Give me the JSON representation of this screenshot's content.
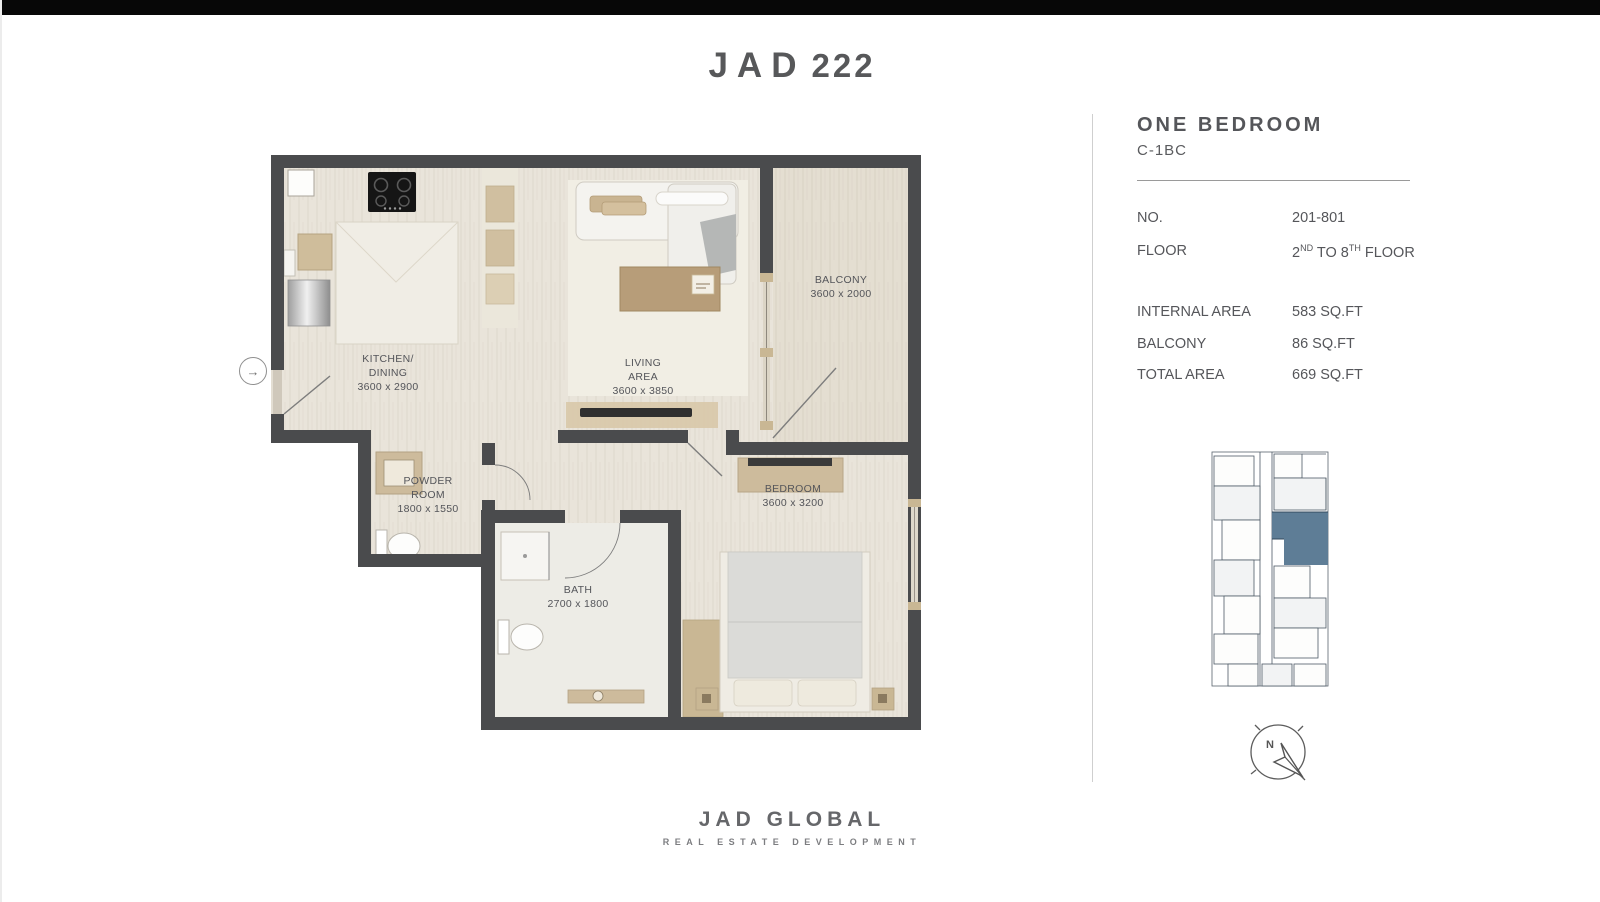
{
  "colors": {
    "top_bar": "#070707",
    "wall": "#4a4b4d",
    "floor": "#e9e4da",
    "balcony_floor": "#e4ded1",
    "keyplan_highlight": "#5e7d96",
    "text": "#55565a"
  },
  "brand": {
    "logo_name": "JAD",
    "logo_number": "222"
  },
  "panel": {
    "title": "ONE BEDROOM",
    "unit_code": "C-1BC",
    "no_label": "NO.",
    "no_value": "201-801",
    "floor_label": "FLOOR",
    "floor_value": {
      "n1": "2",
      "s1": "ND",
      "mid": " TO ",
      "n2": "8",
      "s2": "TH",
      "end": " FLOOR"
    },
    "areas": [
      {
        "label": "INTERNAL AREA",
        "value": "583 SQ.FT"
      },
      {
        "label": "BALCONY",
        "value": "86 SQ.FT"
      },
      {
        "label": "TOTAL AREA",
        "value": "669 SQ.FT"
      }
    ]
  },
  "floorplan": {
    "entry_icon": "→",
    "rooms": {
      "kitchen": {
        "line1": "KITCHEN/",
        "line2": "DINING",
        "dims": "3600 x 2900"
      },
      "living": {
        "line1": "LIVING",
        "line2": "AREA",
        "dims": "3600 x 3850"
      },
      "balcony": {
        "line1": "BALCONY",
        "dims": "3600 x 2000"
      },
      "bedroom": {
        "line1": "BEDROOM",
        "dims": "3600 x 3200"
      },
      "powder": {
        "line1": "POWDER",
        "line2": "ROOM",
        "dims": "1800 x 1550"
      },
      "bath": {
        "line1": "BATH",
        "dims": "2700 x 1800"
      }
    }
  },
  "compass": {
    "north_label": "N"
  },
  "footer": {
    "name": "JAD GLOBAL",
    "tagline": "REAL ESTATE DEVELOPMENT"
  }
}
